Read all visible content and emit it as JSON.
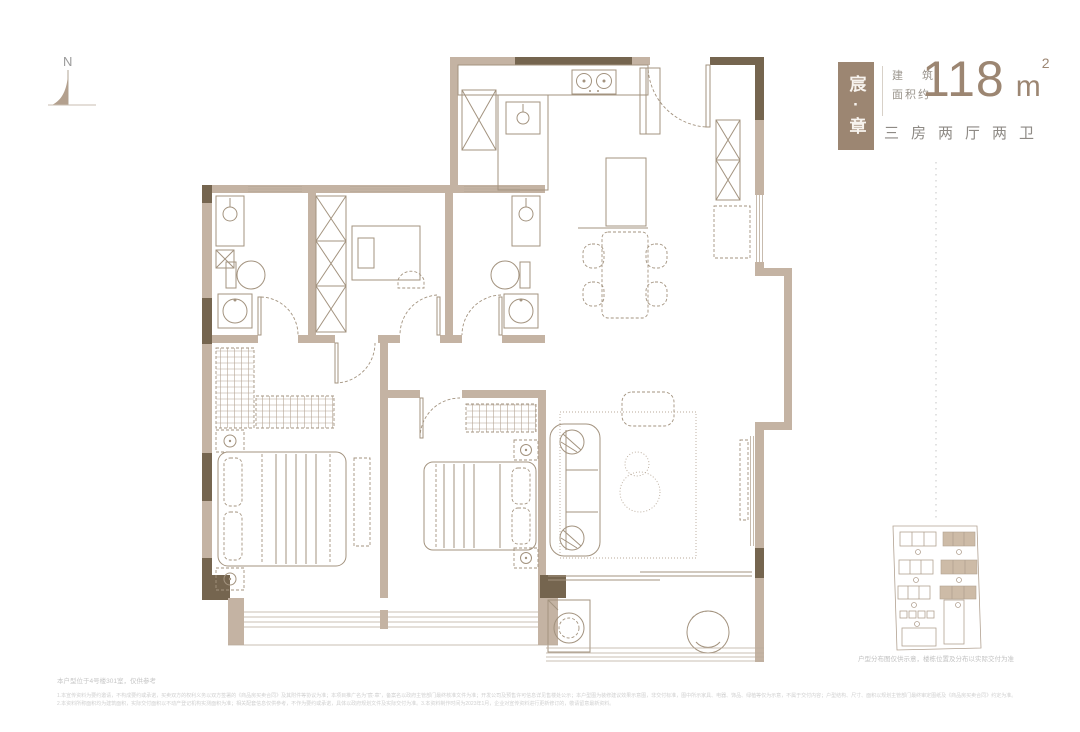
{
  "compass": {
    "label": "N"
  },
  "header": {
    "badge_text": "宸·章",
    "area_label_line1": "建 筑",
    "area_label_line2": "面积约",
    "area_value": "118",
    "area_unit": "m",
    "area_exponent": "2",
    "layout_label": "三房两厅两卫"
  },
  "sitemap": {
    "caption": "户型分布图仅供示意，楼栋位置及分布以实际交付为准"
  },
  "notes": {
    "location_note": "本户型位于4号楼301室，仅供参考",
    "disclaimer_line1": "1.本宣传资料为要约邀请，不构成要约或承诺，买卖双方的权利义务以双方签署的《商品房买卖合同》及其附件等协议为准；本项目推广名为“宸·章”，备案名以政府主管部门最终核准文件为准；开发公司及预售许可信息详见售楼处公示；本户型图为装修建议效果示意图，非交付标准，图中所示家具、电器、饰品、绿植等仅为示意，不属于交付内容；户型结构、尺寸、面积以规划主管部门最终审定图纸及《商品房买卖合同》约定为准。",
    "disclaimer_line2": "2.本资料所称面积均为建筑面积，实际交付面积以不动产登记机构实测面积为准；相关配套信息仅供参考，不作为要约或承诺，具体以政府规划文件及实际交付为准。3.本资料制作时间为2023年1月，企业对宣传资料进行更新修订的，敬请留意最新资料。"
  },
  "colors": {
    "accent_brown": "#9c8672",
    "wall_dark": "#75654f",
    "wall_light": "#c4b3a3",
    "furniture_line": "#a3937f",
    "layout_text_gray": "#8e8a85",
    "muted_text_gray": "#c6c6c6"
  }
}
